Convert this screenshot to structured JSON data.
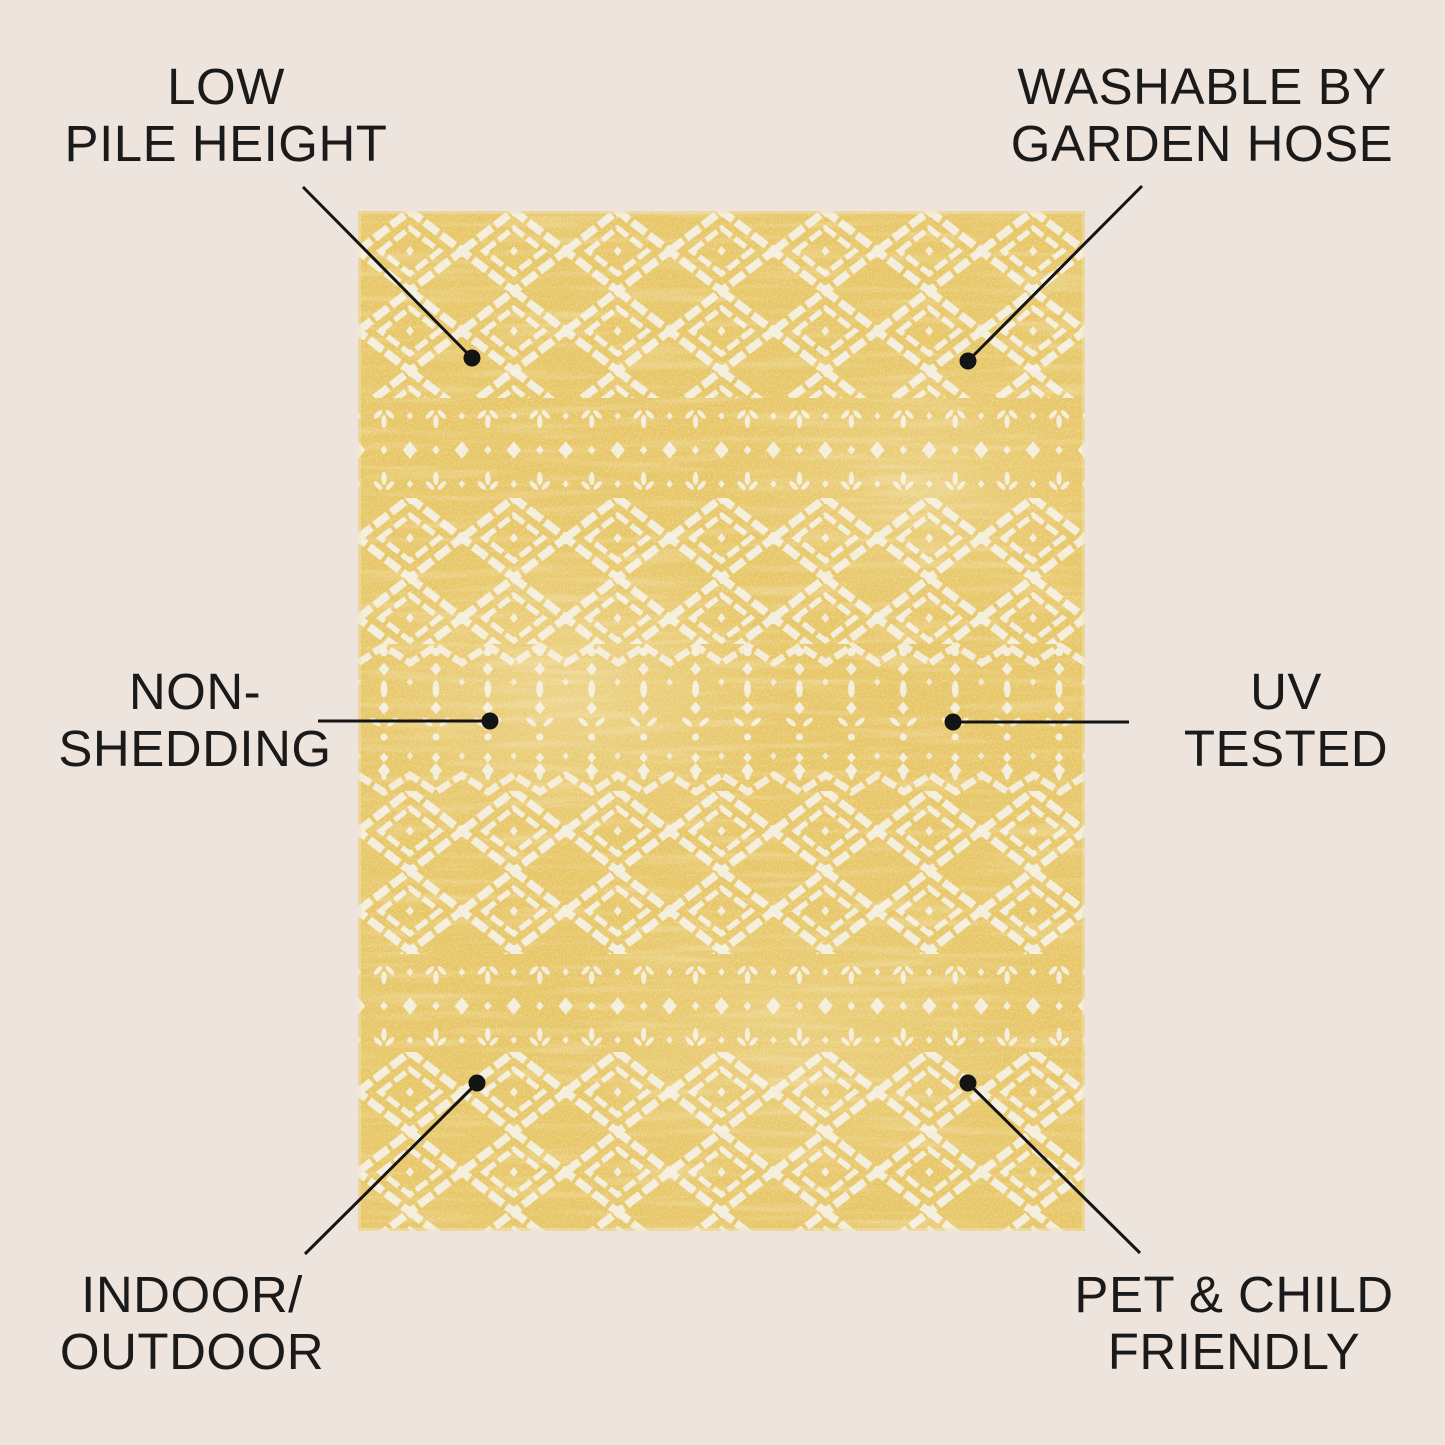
{
  "page": {
    "background_color": "#eee4de"
  },
  "rug": {
    "name": "Moroccan trellis woven rug",
    "base_color": "#e7c666",
    "pattern_color": "#f4eedd",
    "pattern": "cream diamond lattice bands, sprig-and-diamond motif bands, central bead-column band"
  },
  "style": {
    "text_color": "#1a1a1a",
    "leader_line_color": "#141414"
  },
  "callouts": [
    {
      "id": "low-pile-height",
      "lines": [
        "LOW",
        "PILE HEIGHT"
      ]
    },
    {
      "id": "washable-by-garden-hose",
      "lines": [
        "WASHABLE BY",
        "GARDEN HOSE"
      ]
    },
    {
      "id": "non-shedding",
      "lines": [
        "NON-",
        "SHEDDING"
      ]
    },
    {
      "id": "uv-tested",
      "lines": [
        "UV",
        "TESTED"
      ]
    },
    {
      "id": "indoor-outdoor",
      "lines": [
        "INDOOR/",
        "OUTDOOR"
      ]
    },
    {
      "id": "pet-child-friendly",
      "lines": [
        "PET & CHILD",
        "FRIENDLY"
      ]
    }
  ]
}
